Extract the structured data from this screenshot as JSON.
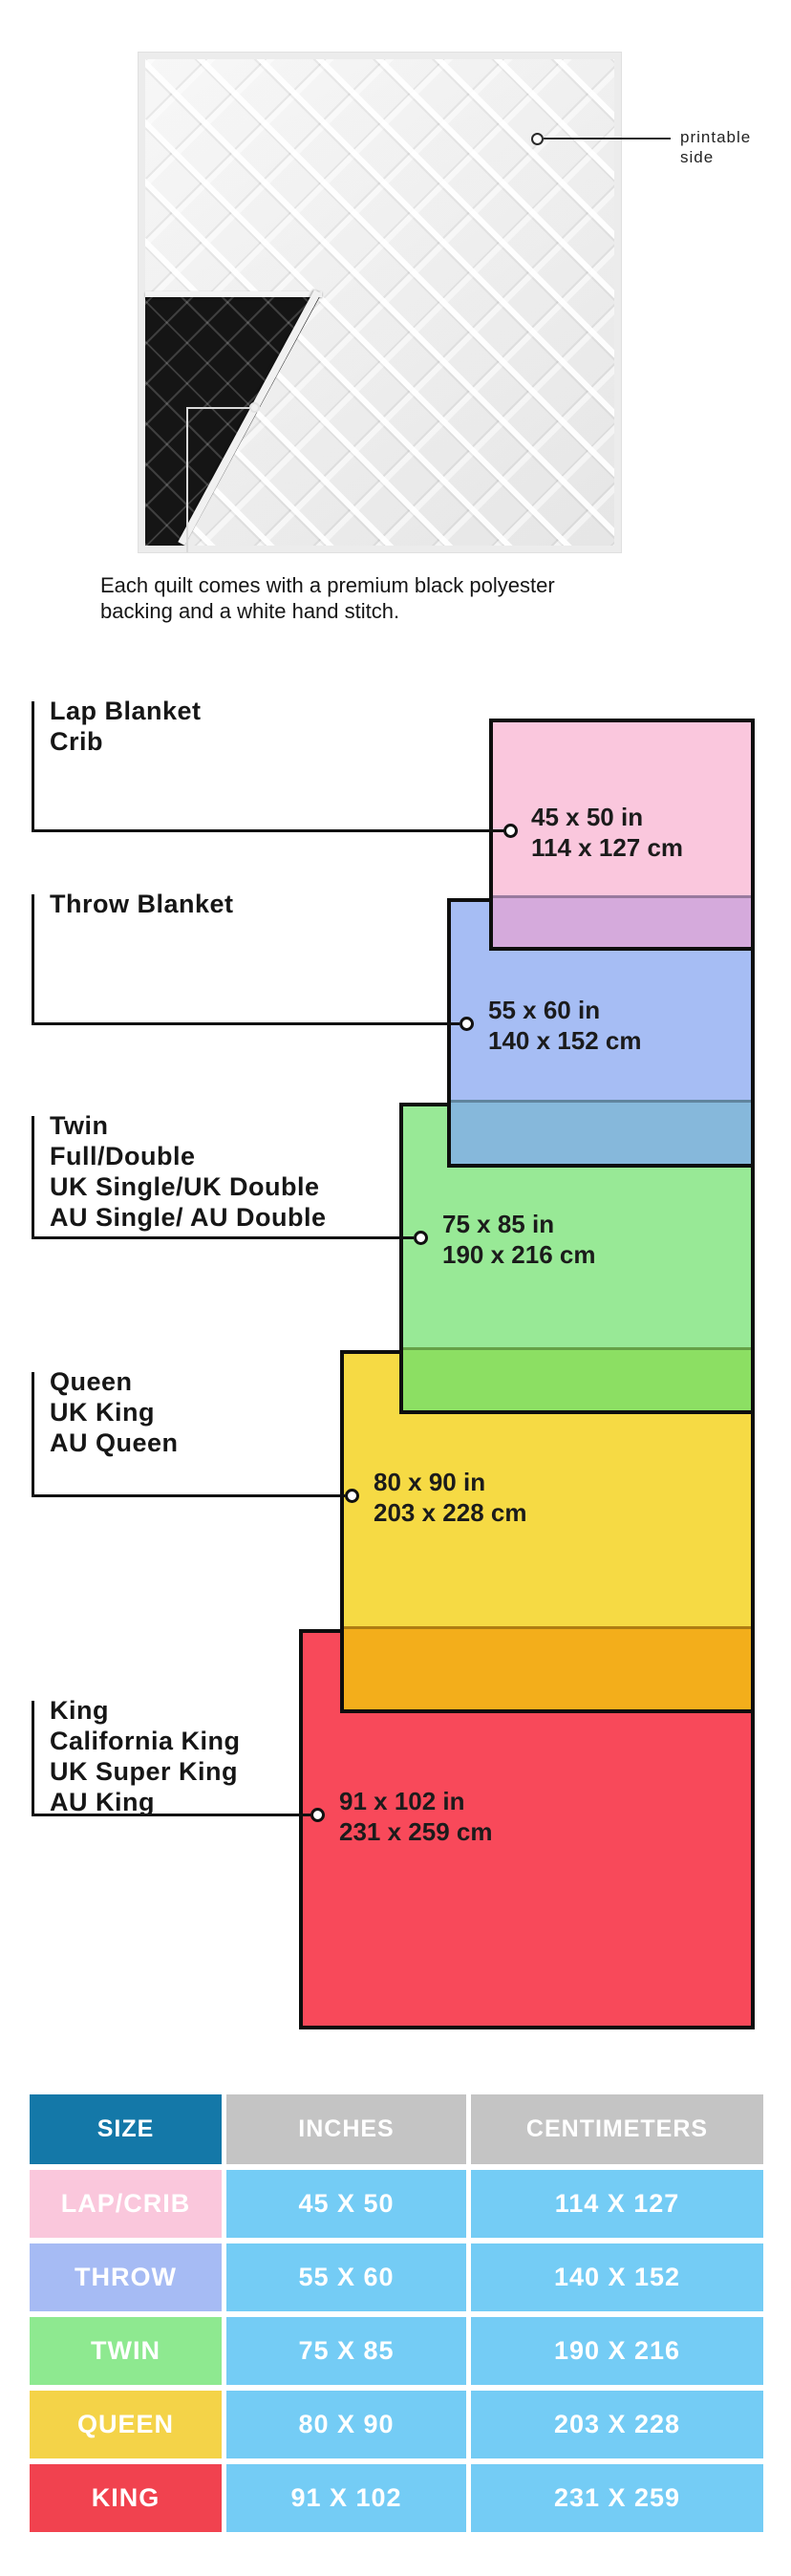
{
  "quilt": {
    "printable_label": {
      "line1": "printable",
      "line2": "side"
    },
    "caption": {
      "line1": "Each quilt comes with a premium black polyester",
      "line2": "backing and a white hand stitch."
    }
  },
  "diagram": {
    "sizes": [
      {
        "name": "lap-crib",
        "labels": [
          "Lap Blanket",
          "Crib"
        ],
        "inches": "45 x 50 in",
        "centimeters": "114 x 127 cm",
        "fill": "#fac7dd",
        "overlap_fill": "#d5aadc"
      },
      {
        "name": "throw",
        "labels": [
          "Throw Blanket"
        ],
        "inches": "55 x 60 in",
        "centimeters": "140 x 152 cm",
        "fill": "#a6bdf4",
        "overlap_fill": "#86b8db"
      },
      {
        "name": "twin",
        "labels": [
          "Twin",
          "Full/Double",
          "UK Single/UK Double",
          "AU Single/ AU Double"
        ],
        "inches": "75 x 85 in",
        "centimeters": "190 x 216 cm",
        "fill": "#98e996",
        "overlap_fill": "#8cdf63"
      },
      {
        "name": "queen",
        "labels": [
          "Queen",
          "UK King",
          "AU Queen"
        ],
        "inches": "80 x 90 in",
        "centimeters": "203 x 228 cm",
        "fill": "#f6da44",
        "overlap_fill": "#f3ae1b"
      },
      {
        "name": "king",
        "labels": [
          "King",
          "California King",
          "UK Super King",
          "AU King"
        ],
        "inches": "91 x 102 in",
        "centimeters": "231 x 259 cm",
        "fill": "#f8495a",
        "overlap_fill": null
      }
    ]
  },
  "table": {
    "headers": {
      "size": "SIZE",
      "inches": "INCHES",
      "centimeters": "CENTIMETERS"
    },
    "header_colors": {
      "size": "#1478a8",
      "other": "#c4c4c4"
    },
    "value_cell_color": "#74ccf5",
    "rows": [
      {
        "size": "LAP/CRIB",
        "inches": "45 X 50",
        "centimeters": "114 X 127",
        "color": "#fac7dc"
      },
      {
        "size": "THROW",
        "inches": "55 X 60",
        "centimeters": "140 X 152",
        "color": "#a6bbf4"
      },
      {
        "size": "TWIN",
        "inches": "75 X 85",
        "centimeters": "190 X 216",
        "color": "#8ee990"
      },
      {
        "size": "QUEEN",
        "inches": "80 X 90",
        "centimeters": "203 X 228",
        "color": "#f4d348"
      },
      {
        "size": "KING",
        "inches": "91 X 102",
        "centimeters": "231 X 259",
        "color": "#f1424f"
      }
    ]
  }
}
